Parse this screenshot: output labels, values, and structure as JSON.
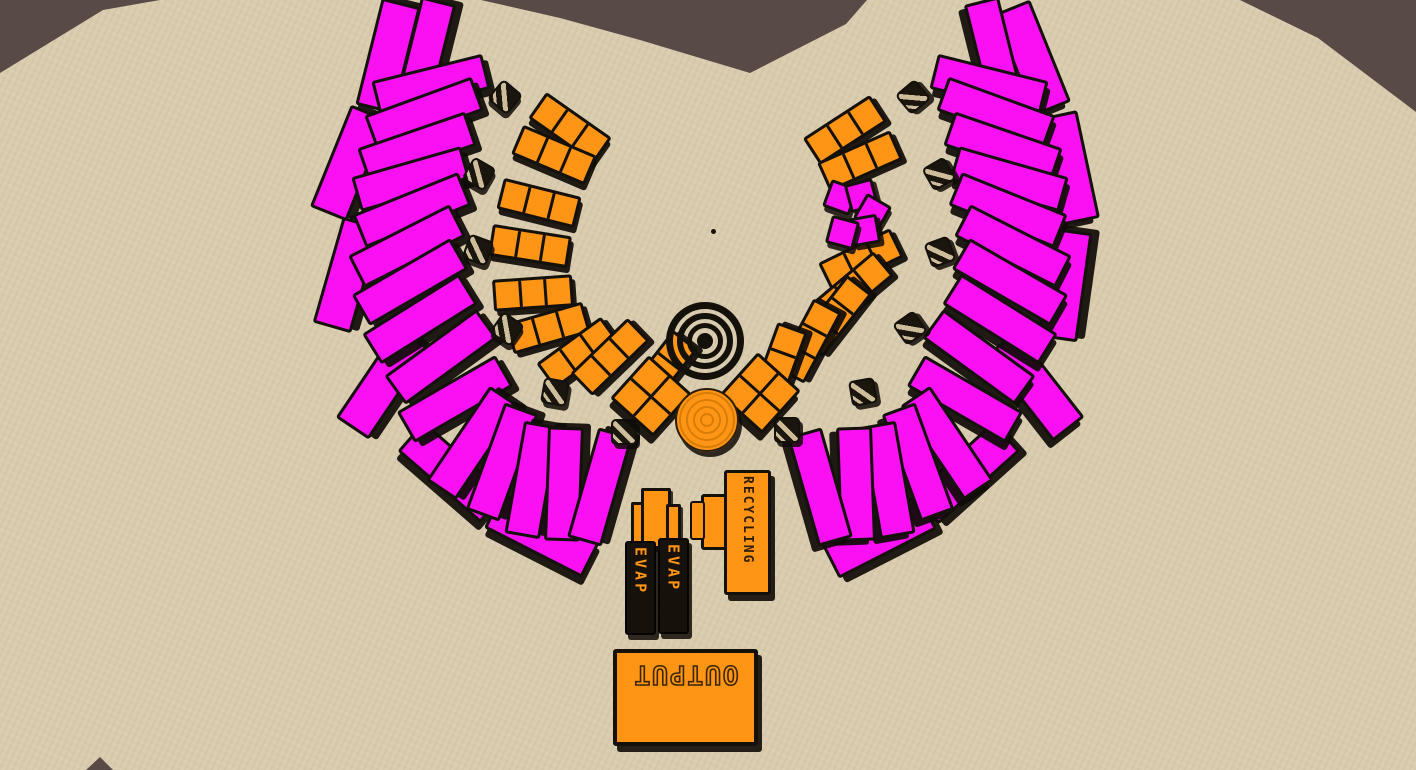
{
  "scene": {
    "description": "top-down factory colony with two magenta solar fans around a central hub",
    "colors": {
      "ground_tan": "#D9CCAE",
      "rock_dark_brown": "#584B47",
      "magenta": "#FA10F2",
      "orange": "#FF9415",
      "outline_black": "#14100A"
    }
  },
  "terrain": {
    "patches": [
      {
        "name": "rock-top-left",
        "points": [
          [
            0,
            0
          ],
          [
            160,
            0
          ],
          [
            103,
            10
          ],
          [
            0,
            73
          ]
        ]
      },
      {
        "name": "rock-top-center",
        "points": [
          [
            481,
            0
          ],
          [
            867,
            0
          ],
          [
            846,
            24
          ],
          [
            750,
            73
          ],
          [
            640,
            40
          ],
          [
            560,
            18
          ]
        ]
      },
      {
        "name": "rock-top-right",
        "points": [
          [
            1240,
            0
          ],
          [
            1416,
            0
          ],
          [
            1416,
            112
          ],
          [
            1318,
            38
          ]
        ]
      },
      {
        "name": "rock-bottom-left",
        "points": [
          [
            86,
            770
          ],
          [
            113,
            770
          ],
          [
            100,
            757
          ]
        ]
      }
    ]
  },
  "buildings": {
    "recycling": {
      "label": "RECYCLING"
    },
    "evap_towers": [
      {
        "label": "EVAP"
      },
      {
        "label": "EVAP"
      }
    ],
    "output": {
      "label": "OUTPUT"
    }
  },
  "objects": {
    "outer_slabs": {
      "name": "outer-panel",
      "items": [
        [
          385,
          53,
          -76
        ],
        [
          346,
          160,
          -68
        ],
        [
          344,
          272,
          -74
        ],
        [
          380,
          380,
          -56
        ],
        [
          449,
          469,
          41
        ],
        [
          539,
          532,
          27
        ],
        [
          1029,
          55,
          68
        ],
        [
          1066,
          165,
          78
        ],
        [
          1062,
          282,
          -82
        ],
        [
          1032,
          383,
          52
        ],
        [
          963,
          470,
          -42
        ],
        [
          876,
          533,
          -27
        ]
      ]
    },
    "fan_panels": {
      "name": "solar-panel",
      "items": [
        [
          422,
          53,
          -76
        ],
        [
          428,
          82,
          -14
        ],
        [
          421,
          110,
          -20
        ],
        [
          414,
          144,
          -19
        ],
        [
          408,
          176,
          -16
        ],
        [
          409,
          207,
          -22
        ],
        [
          404,
          243,
          -27
        ],
        [
          407,
          279,
          -30
        ],
        [
          417,
          316,
          -32
        ],
        [
          438,
          354,
          -36
        ],
        [
          452,
          396,
          -30
        ],
        [
          470,
          440,
          -56
        ],
        [
          499,
          459,
          -70
        ],
        [
          529,
          477,
          -80
        ],
        [
          561,
          481,
          -88
        ],
        [
          597,
          484,
          -74
        ],
        [
          992,
          53,
          76
        ],
        [
          986,
          82,
          14
        ],
        [
          993,
          110,
          20
        ],
        [
          1000,
          144,
          19
        ],
        [
          1006,
          176,
          16
        ],
        [
          1005,
          207,
          22
        ],
        [
          1010,
          243,
          27
        ],
        [
          1007,
          279,
          30
        ],
        [
          997,
          316,
          32
        ],
        [
          976,
          354,
          36
        ],
        [
          962,
          396,
          30
        ],
        [
          944,
          440,
          56
        ],
        [
          915,
          459,
          70
        ],
        [
          885,
          477,
          80
        ],
        [
          853,
          481,
          88
        ],
        [
          817,
          484,
          74
        ]
      ]
    },
    "collector_strips": {
      "name": "collector-strip",
      "items": [
        [
          567,
          125,
          35
        ],
        [
          551,
          152,
          23
        ],
        [
          536,
          200,
          14
        ],
        [
          527,
          243,
          9
        ],
        [
          530,
          290,
          -4
        ],
        [
          545,
          325,
          -16
        ],
        [
          575,
          350,
          -36
        ],
        [
          607,
          354,
          -44
        ],
        [
          658,
          368,
          -52
        ],
        [
          842,
          127,
          -33
        ],
        [
          857,
          158,
          -24
        ],
        [
          858,
          257,
          -26
        ],
        [
          850,
          286,
          -40
        ],
        [
          832,
          313,
          -52
        ],
        [
          806,
          338,
          -62
        ],
        [
          776,
          362,
          -70
        ]
      ]
    },
    "crates": {
      "name": "supply-crate",
      "items": [
        [
          503,
          95,
          40
        ],
        [
          477,
          172,
          30
        ],
        [
          476,
          248,
          20
        ],
        [
          505,
          327,
          35
        ],
        [
          553,
          390,
          10
        ],
        [
          622,
          430,
          0
        ],
        [
          911,
          95,
          -40
        ],
        [
          937,
          172,
          -30
        ],
        [
          938,
          250,
          -20
        ],
        [
          908,
          326,
          -35
        ],
        [
          861,
          390,
          -10
        ],
        [
          785,
          428,
          0
        ]
      ]
    },
    "quad_blocks": {
      "name": "quad-block",
      "items": [
        [
          648,
          393,
          42
        ],
        [
          757,
          390,
          42
        ]
      ]
    },
    "mini_blocks": {
      "name": "mini-block",
      "items": [
        [
          837,
          194,
          20
        ],
        [
          858,
          192,
          -15
        ],
        [
          869,
          209,
          30
        ],
        [
          861,
          227,
          -10
        ],
        [
          839,
          229,
          15
        ]
      ]
    },
    "map_dot": {
      "name": "map-dot",
      "x": 713,
      "y": 231
    }
  }
}
